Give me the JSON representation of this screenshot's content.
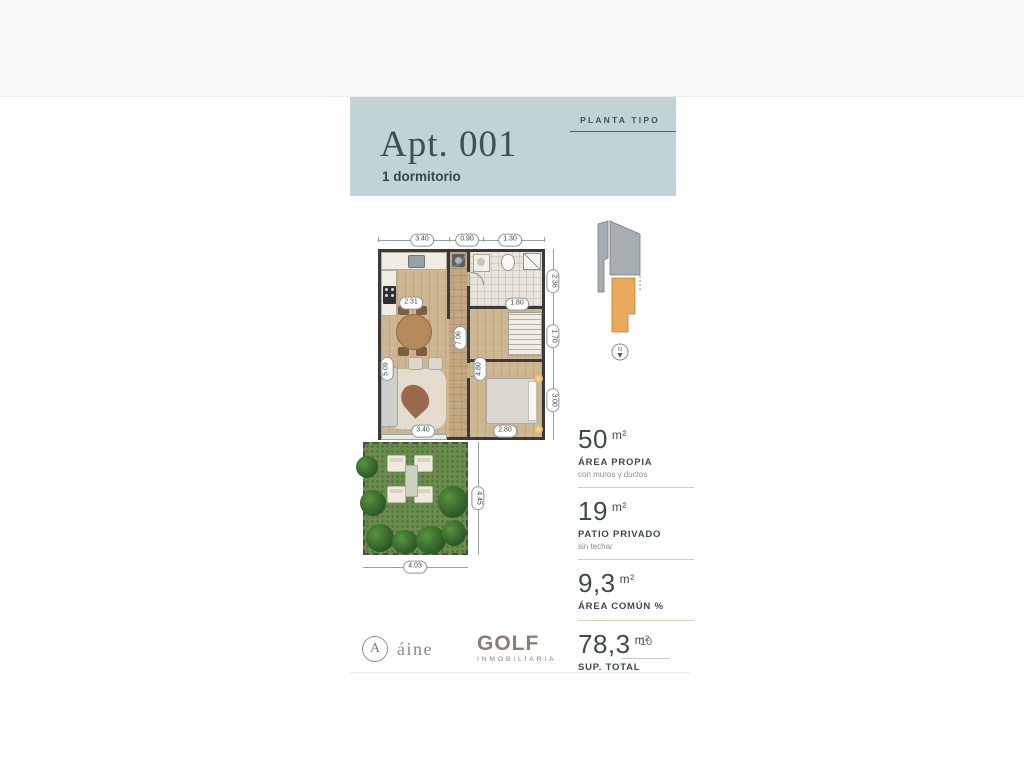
{
  "header": {
    "tag": "PLANTA TIPO",
    "title": "Apt. 001",
    "subtitle": "1 dormitorio"
  },
  "floor_plan": {
    "dims": {
      "top_left": "3.40",
      "top_mid": "0.90",
      "top_right": "1.30",
      "kitchen": "2.31",
      "bath": "1.80",
      "right_top": "2.36",
      "right_mid": "1.70",
      "right_bottom": "3.00",
      "hall": "7.06",
      "bedroom": "4.80",
      "living": "5.09",
      "bottom_left": "3.40",
      "bottom_right": "2.80",
      "patio_height": "4.45",
      "patio_width": "4.03"
    },
    "compass_label": "N"
  },
  "stats": [
    {
      "value": "50",
      "unit": "m²",
      "label": "ÁREA PROPIA",
      "note": "con muros y ductos"
    },
    {
      "value": "19",
      "unit": "m²",
      "label": "PATIO PRIVADO",
      "note": "sin techar"
    },
    {
      "value": "9,3",
      "unit": "m²",
      "label": "ÁREA COMÚN %",
      "note": ""
    },
    {
      "value": "78,3",
      "unit": "m²",
      "label": "SUP. TOTAL",
      "note": ""
    }
  ],
  "footer": {
    "brand_aine_monogram": "A",
    "brand_aine": "áine",
    "brand_golf": "GOLF",
    "brand_golf_sub": "INMOBILIARIA",
    "page_number": "10"
  },
  "colors": {
    "header_bg": "#c2d3d5",
    "keyplan_gray": "#a7aeb1",
    "keyplan_orange": "#e8a95c",
    "wall": "#3a3a3a",
    "grass": "#6a8d4e",
    "text_dark": "#3e4b49",
    "divider": "#d9d0ba"
  }
}
